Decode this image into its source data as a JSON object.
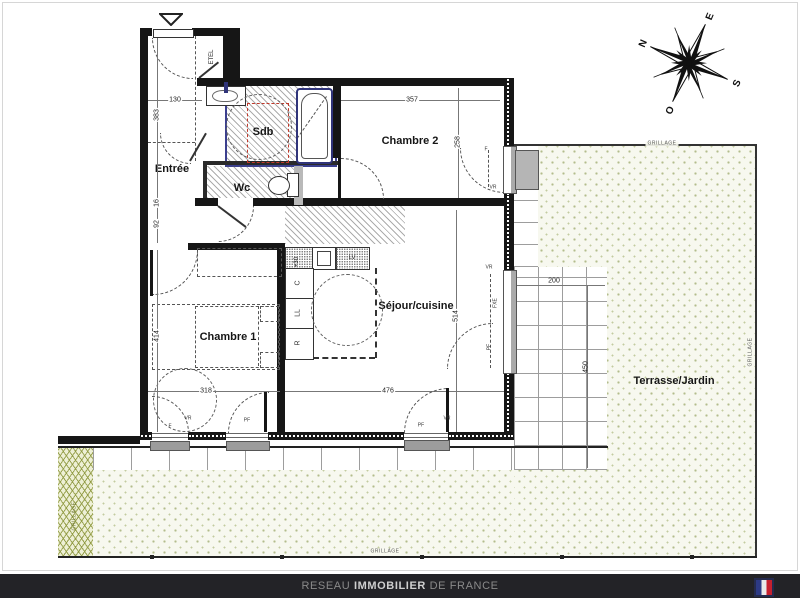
{
  "plan": {
    "rooms": {
      "entree": "Entrée",
      "sdb": "Sdb",
      "wc": "Wc",
      "etel": "ETEL",
      "chambre2": "Chambre 2",
      "chambre1": "Chambre 1",
      "sejour": "Séjour/cuisine",
      "terrasse": "Terrasse/Jardin"
    },
    "dims": {
      "d130": "130",
      "d383": "383",
      "d16": "16",
      "d92": "92",
      "d357": "357",
      "d258": "258",
      "d414": "414",
      "d318": "318",
      "d476": "476",
      "d514": "514",
      "d200": "200",
      "d450": "450",
      "plus30": "+30"
    },
    "kitchen": {
      "lv": "LV",
      "c": "C",
      "ll": "LL",
      "r": "R"
    },
    "open": {
      "vr": "VR",
      "pf": "PF",
      "f": "F",
      "fxe": "FXE"
    },
    "fence_label": "GRILLAGE",
    "compass": {
      "n": "N",
      "e": "E",
      "s": "S",
      "o": "O"
    }
  },
  "footer": {
    "part1": "RESEAU",
    "part2": "IMMOBILIER",
    "part3": "DE FRANCE"
  },
  "colors": {
    "wall": "#161616",
    "sdb_outline": "#3b3f8e",
    "shower_red": "#c0392b",
    "garden_dot": "#b3bc8c",
    "footer_bg": "#232327",
    "flag_blue": "#2d3a85",
    "flag_red": "#c6202e"
  }
}
